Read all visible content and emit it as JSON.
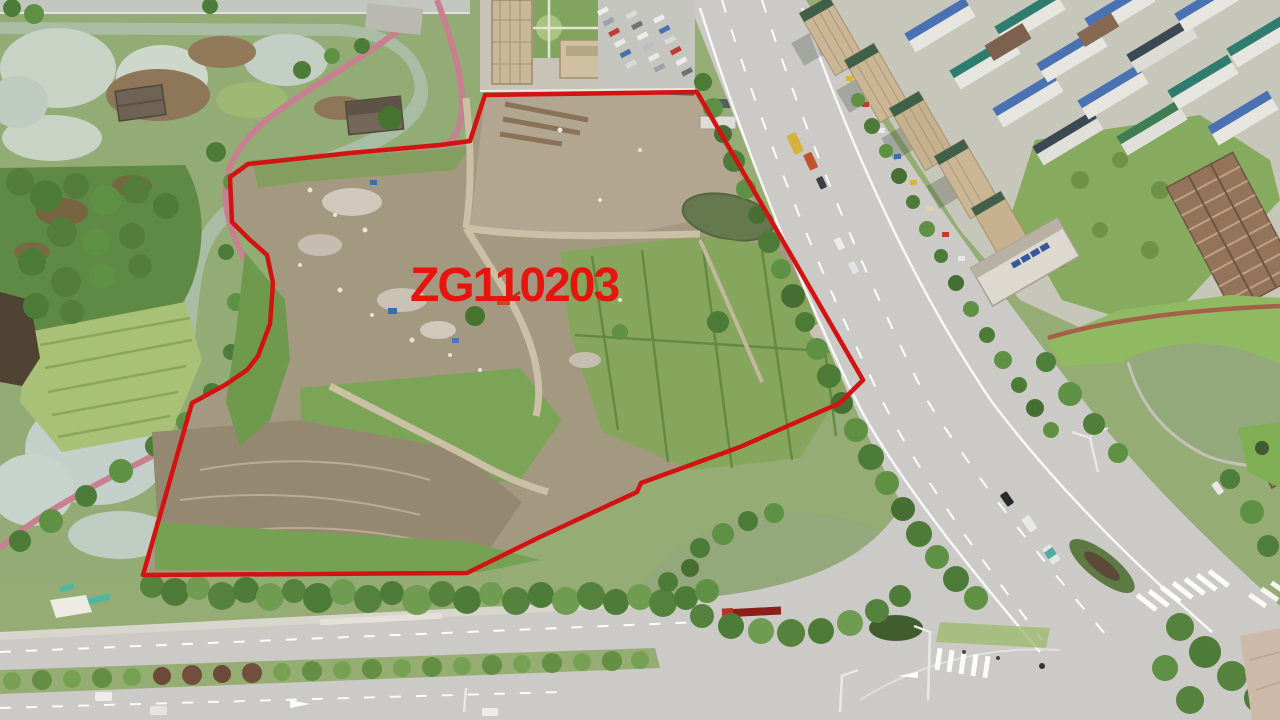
{
  "annotation": {
    "parcel_label": "ZG110203",
    "label_color": "#e8150f",
    "label_font_size": 48,
    "label_x": 410,
    "label_y": 301,
    "boundary_color": "#d31212",
    "boundary_stroke_width": 4.5,
    "boundary_points": "485,95 697,92 863,380 840,403 740,447 641,483 637,492 540,537 467,573 143,575 192,403 225,385 247,370 258,356 270,324 273,283 267,255 249,239 232,222 230,177 248,164 350,153 440,145 470,141"
  },
  "scene": {
    "palette": {
      "dirt": "#a39880",
      "dirt_light": "#b2a691",
      "mud": "#948871",
      "grass": "#95ac74",
      "field_green": "#85a65c",
      "brush_green": "#7ca457",
      "tree_dark": "#4d7c38",
      "tree_mid": "#5f9144",
      "water_pale": "#c8d3c6",
      "water_green": "#93a87b",
      "road_gray": "#cbcac6",
      "path_pink": "#c87f90",
      "building_tan": "#cab694",
      "roof_blue": "#4a72b2",
      "roof_teal": "#2f7d6e",
      "roof_dark": "#3c4852",
      "tower_brown": "#93745a",
      "marking_white": "#ffffff"
    }
  }
}
